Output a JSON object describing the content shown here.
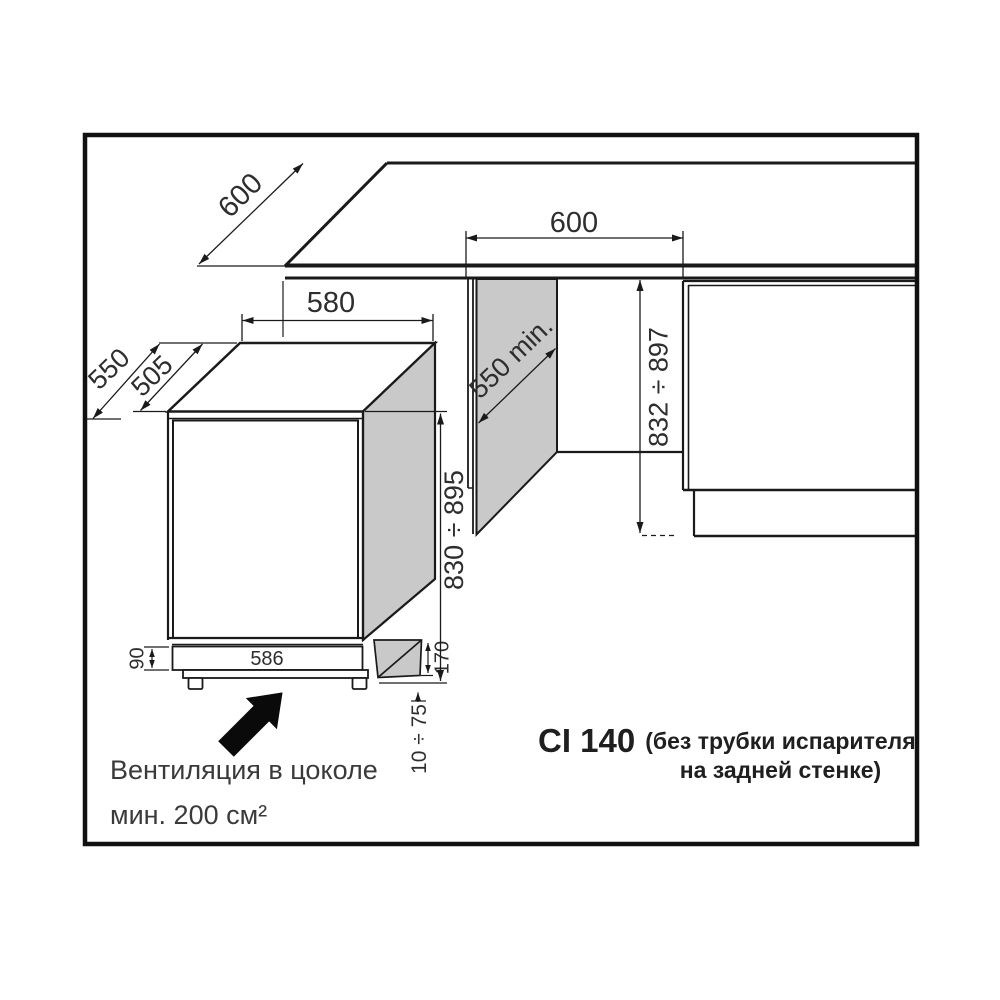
{
  "model": {
    "name": "CI 140",
    "note_line1": "(без трубки испарителя",
    "note_line2": "на задней стенке)"
  },
  "ventilation_note": {
    "line1": "Вентиляция в цоколе",
    "line2": "мин. 200 см²"
  },
  "dims": {
    "counter_depth": "600",
    "niche_width": "600",
    "appliance_width": "580",
    "total_depth": "550",
    "body_depth": "505",
    "niche_depth_min": "550 min.",
    "niche_height_range": "832 ÷ 897",
    "appliance_height_range": "830 ÷ 895",
    "plinth_height": "90",
    "plinth_recess_width": "586",
    "rear_recess_depth": "170",
    "feet_adjust_range": "10 ÷ 75"
  },
  "colors": {
    "line": "#1a1a1a",
    "panel_gray": "#c9c9c9",
    "text": "#2f2f2f",
    "background": "#ffffff"
  }
}
